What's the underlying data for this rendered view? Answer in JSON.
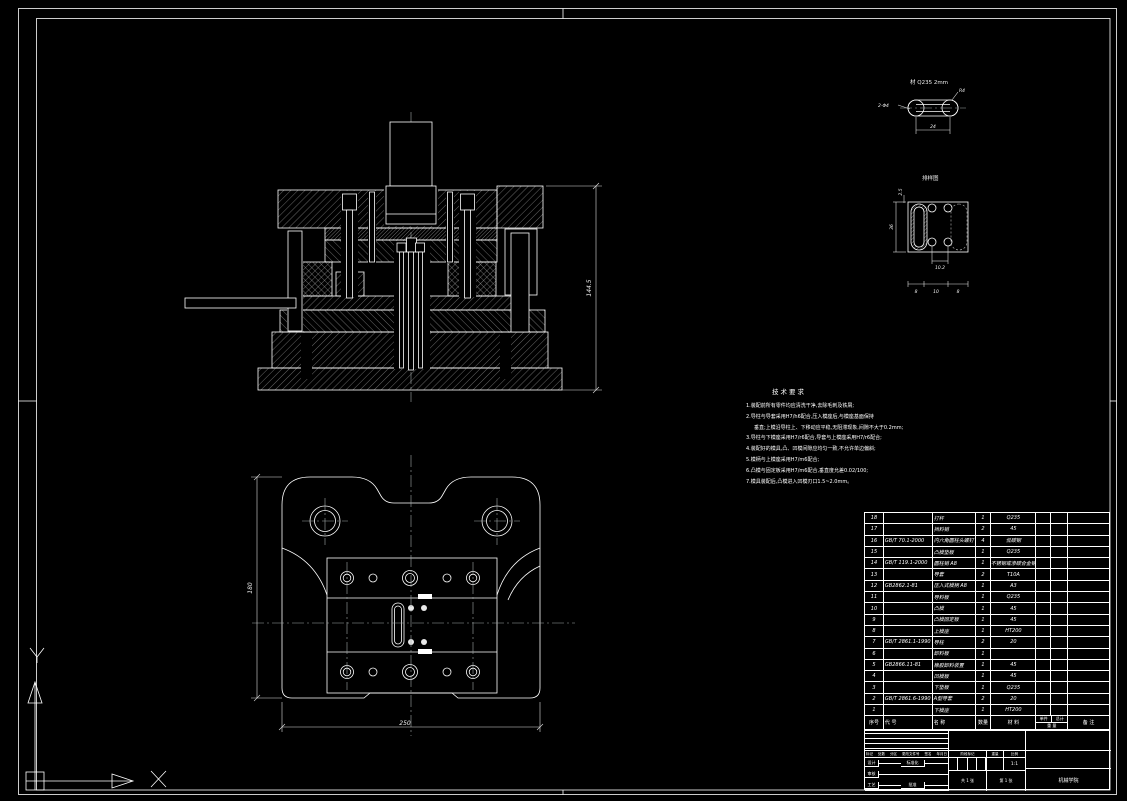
{
  "palette": {
    "bg": "#000000",
    "line": "#ffffff",
    "dim": "#e8e8e8"
  },
  "section_view": {
    "dim_total_height": "144.5"
  },
  "plan_view": {
    "dim_width": "250",
    "dim_height": "180"
  },
  "part_detail": {
    "material_note": "材 Q235 2mm",
    "radius_label": "R4",
    "length_label": "24",
    "holes_label": "2-Φ4"
  },
  "strip_layout": {
    "title": "排样图",
    "edge_margin": "2.5",
    "strip_width": "36",
    "hole_pitch": "10.2",
    "spacing": [
      "8",
      "10",
      "8"
    ]
  },
  "tech_notes": {
    "title": "技术要求",
    "lines": [
      "1.装配前所有零件均应清洗干净,去除毛刺及铁屑;",
      "2.导柱与导套采用H7/h6配合,压入模座后,与模座基面保持",
      "垂直;上模沿导柱上、下移动应平稳,无阻滞现象,间隙不大于0.2mm;",
      "3.导柱与下模座采用H7/r6配合,导套与上模座采用H7/r6配合;",
      "4.装配好的模具,凸、凹模间隙应均匀一致,不允许单边偏斜;",
      "5.模柄与上模座采用H7/m6配合;",
      "6.凸模与固定板采用H7/m6配合,垂直度允差0.02/100;",
      "7.模具装配后,凸模进入凹模刃口1.5~2.0mm。"
    ]
  },
  "parts_table": {
    "headers": {
      "no": "序号",
      "code": "代 号",
      "name": "名 称",
      "qty": "数量",
      "material": "材 料",
      "unit": "单件",
      "total": "总计",
      "weight": "重 量",
      "remark": "备 注"
    },
    "rows": [
      {
        "no": "18",
        "code": "",
        "name": "打杆",
        "qty": "1",
        "material": "Q235"
      },
      {
        "no": "17",
        "code": "",
        "name": "挡料销",
        "qty": "2",
        "material": "45"
      },
      {
        "no": "16",
        "code": "GB/T 70.1-2000",
        "name": "内六角圆柱头螺钉",
        "qty": "4",
        "material": "低碳钢"
      },
      {
        "no": "15",
        "code": "",
        "name": "凸模垫板",
        "qty": "1",
        "material": "Q235"
      },
      {
        "no": "14",
        "code": "GB/T 119.1-2000",
        "name": "圆柱销 A8",
        "qty": "1",
        "material": "不锈钢或渗碳合金钢"
      },
      {
        "no": "13",
        "code": "",
        "name": "导套",
        "qty": "2",
        "material": "T10A"
      },
      {
        "no": "12",
        "code": "GB2862.1-81",
        "name": "压入式模柄 A8",
        "qty": "1",
        "material": "A3"
      },
      {
        "no": "11",
        "code": "",
        "name": "导料板",
        "qty": "1",
        "material": "Q235"
      },
      {
        "no": "10",
        "code": "",
        "name": "凸模",
        "qty": "1",
        "material": "45"
      },
      {
        "no": "9",
        "code": "",
        "name": "凸模固定板",
        "qty": "1",
        "material": "45"
      },
      {
        "no": "8",
        "code": "",
        "name": "上模座",
        "qty": "1",
        "material": "HT200"
      },
      {
        "no": "7",
        "code": "GB/T 2861.1-1990",
        "name": "导柱",
        "qty": "2",
        "material": "20"
      },
      {
        "no": "6",
        "code": "",
        "name": "卸料板",
        "qty": "1",
        "material": ""
      },
      {
        "no": "5",
        "code": "GB2866.11-81",
        "name": "橡胶卸料装置",
        "qty": "1",
        "material": "45"
      },
      {
        "no": "4",
        "code": "",
        "name": "凹模板",
        "qty": "1",
        "material": "45"
      },
      {
        "no": "3",
        "code": "",
        "name": "下垫板",
        "qty": "1",
        "material": "Q235"
      },
      {
        "no": "2",
        "code": "GB/T 2861.6-1990",
        "name": "A型导套",
        "qty": "2",
        "material": "20"
      },
      {
        "no": "1",
        "code": "",
        "name": "下模座",
        "qty": "1",
        "material": "HT200"
      }
    ]
  },
  "title_block": {
    "revision_labels": [
      "标记",
      "处数",
      "分区",
      "更改文件号",
      "签名",
      "年月日"
    ],
    "sign_labels": {
      "design": "设计",
      "check": "审核",
      "process": "工艺",
      "standard": "标准化",
      "approve": "批准"
    },
    "stage_label": "阶段标记",
    "weight_label": "重量",
    "scale_label": "比例",
    "scale_value": "1:1",
    "sheet_total": "共 1 张",
    "sheet_no": "第 1 张",
    "org": "机械学院"
  }
}
